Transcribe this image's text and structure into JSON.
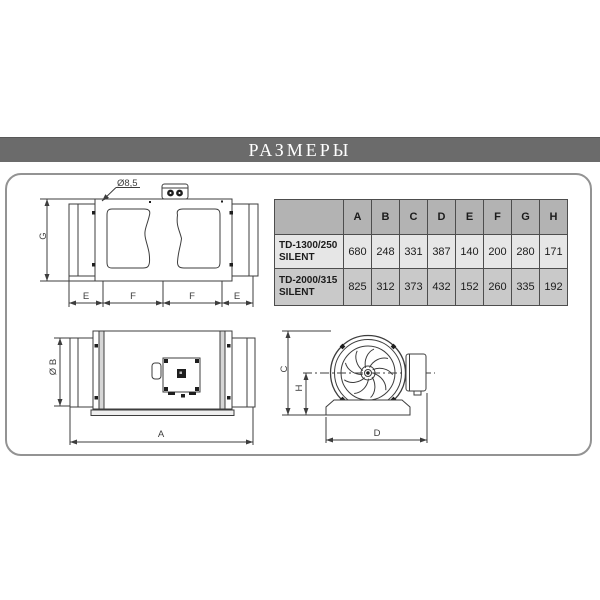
{
  "title_bar": {
    "label": "РАЗМЕРЫ"
  },
  "dimensions_table": {
    "corner_label": "",
    "col_headers": [
      "A",
      "B",
      "C",
      "D",
      "E",
      "F",
      "G",
      "H"
    ],
    "rows": [
      {
        "model_line1": "TD-1300/250",
        "model_line2": "SILENT",
        "values": [
          "680",
          "248",
          "331",
          "387",
          "140",
          "200",
          "280",
          "171"
        ]
      },
      {
        "model_line1": "TD-2000/315",
        "model_line2": "SILENT",
        "values": [
          "825",
          "312",
          "373",
          "432",
          "152",
          "260",
          "335",
          "192"
        ]
      }
    ]
  },
  "side_view": {
    "hole_diameter_label": "Ø8,5",
    "height_label": "G",
    "chain_labels": [
      "E",
      "F",
      "F",
      "E"
    ]
  },
  "top_view": {
    "duct_diameter_label": "Ø B",
    "overall_length_label": "A"
  },
  "end_view": {
    "overall_height_label": "C",
    "axis_height_label": "H",
    "base_width_label": "D"
  },
  "colors": {
    "title_bar_bg": "#6b6b6b",
    "title_text": "#ffffff",
    "panel_border": "#939393",
    "table_header_bg": "#b3b3b3",
    "table_row1_bg": "#e6e6e6",
    "table_row2_bg": "#c9c9c9",
    "table_border": "#4d4d4d",
    "line_color": "#3d3d3d"
  }
}
